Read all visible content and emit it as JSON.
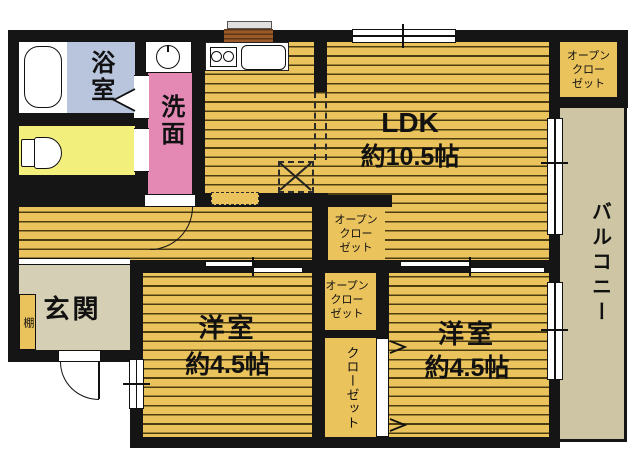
{
  "rooms": {
    "ldk": {
      "label": "LDK",
      "size": "約10.5帖"
    },
    "bedroom_left": {
      "label": "洋室",
      "size": "約4.5帖"
    },
    "bedroom_right": {
      "label": "洋室",
      "size": "約4.5帖"
    },
    "bath": {
      "label": "浴室"
    },
    "washroom": {
      "label": "洗面"
    },
    "entrance": {
      "label": "玄関"
    },
    "shelf": {
      "label": "棚"
    },
    "balcony": {
      "label": "バルコニー"
    },
    "closet": {
      "label": "クローゼット"
    },
    "open_closet_top_right": {
      "label": "オープン\nクロー\nゼット"
    },
    "open_closet_ldk": {
      "label": "オープン\nクロー\nゼット"
    },
    "open_closet_middle": {
      "label": "オープン\nクロー\nゼット"
    }
  },
  "colors": {
    "wall": "#151515",
    "floor": "#ebc35c",
    "floor_stripe": "#4c3c12",
    "bath": "#b9c4dd",
    "toilet": "#f2ef7d",
    "washroom": "#e389b4",
    "entrance": "#d5cfb5",
    "balcony": "#cdc5a3",
    "kitchen_window": "#9b5a27"
  }
}
